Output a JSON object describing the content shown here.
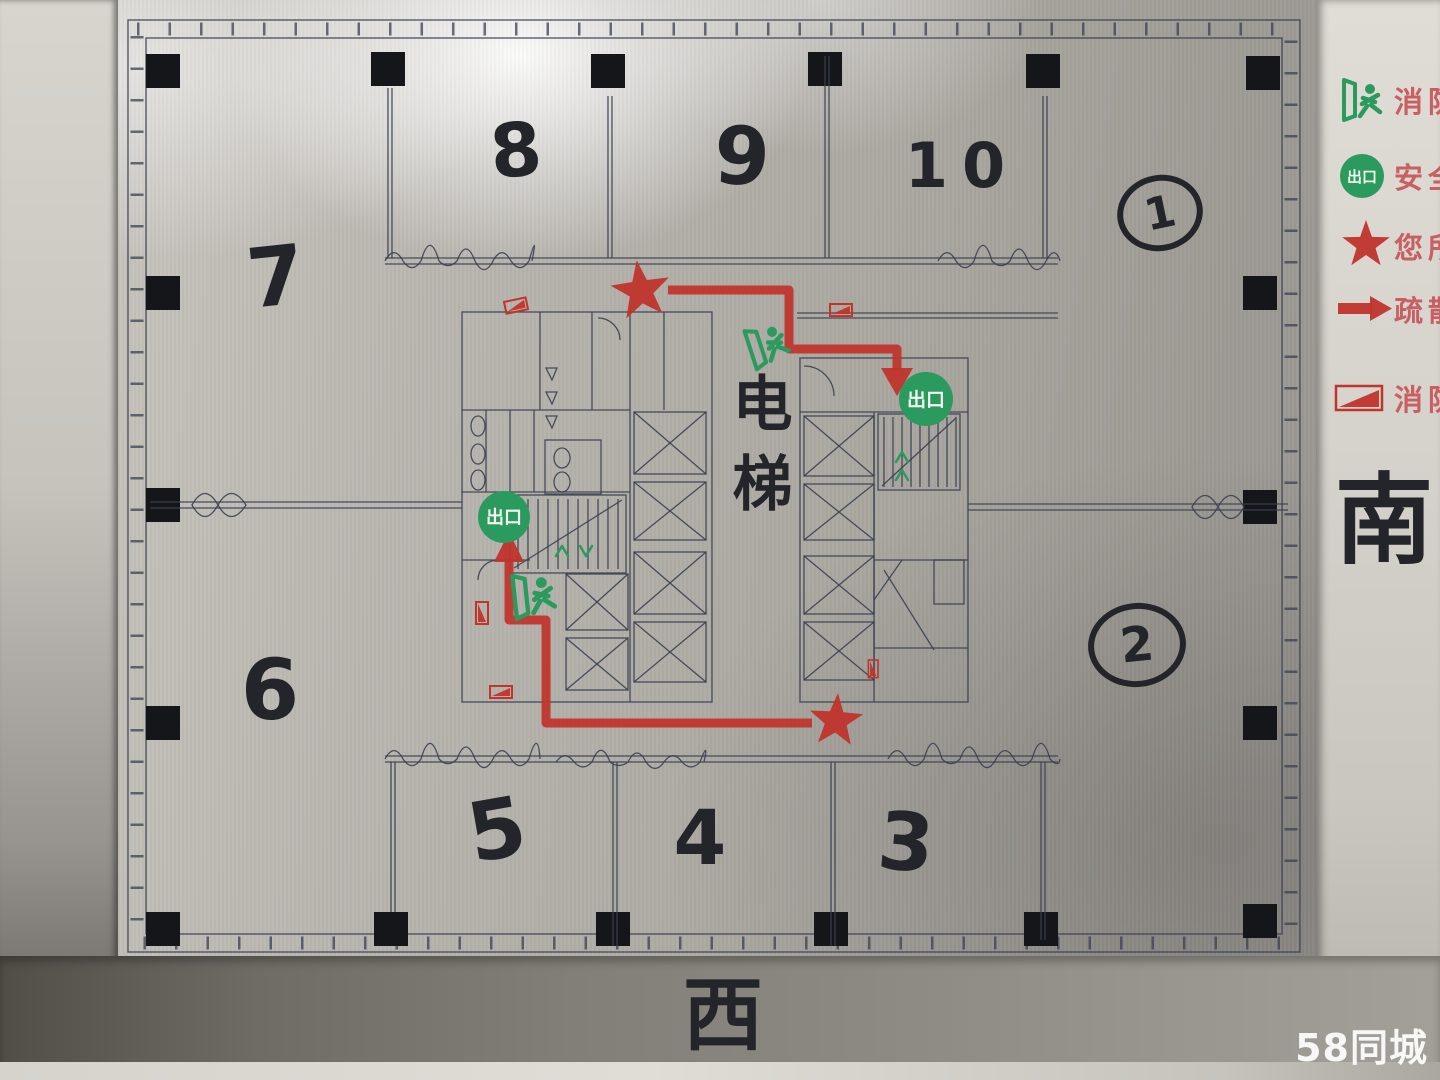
{
  "plan": {
    "elevator_label": "电梯",
    "exit_label": "出口",
    "rooms": {
      "r3": "3",
      "r4": "4",
      "r5": "5",
      "r6": "6",
      "r7": "7",
      "r8": "8",
      "r9": "9",
      "r10": "10"
    },
    "zones": {
      "z1": "1",
      "z2": "2"
    }
  },
  "compass": {
    "south": "南",
    "west": "西"
  },
  "legend": {
    "items": [
      {
        "name": "fire-escape-exit",
        "label": "消防"
      },
      {
        "name": "safety-exit",
        "label": "安全"
      },
      {
        "name": "your-location",
        "label": "您所"
      },
      {
        "name": "evacuation-direction",
        "label": "疏散"
      },
      {
        "name": "fire-hydrant",
        "label": "消防"
      }
    ]
  },
  "watermark": {
    "text": "58同城"
  },
  "colors": {
    "route_red": "#c0342b",
    "sign_green": "#2a9a5e",
    "legend_text": "#c75f63",
    "plan_line": "#3a4050",
    "ink": "#23252b"
  }
}
